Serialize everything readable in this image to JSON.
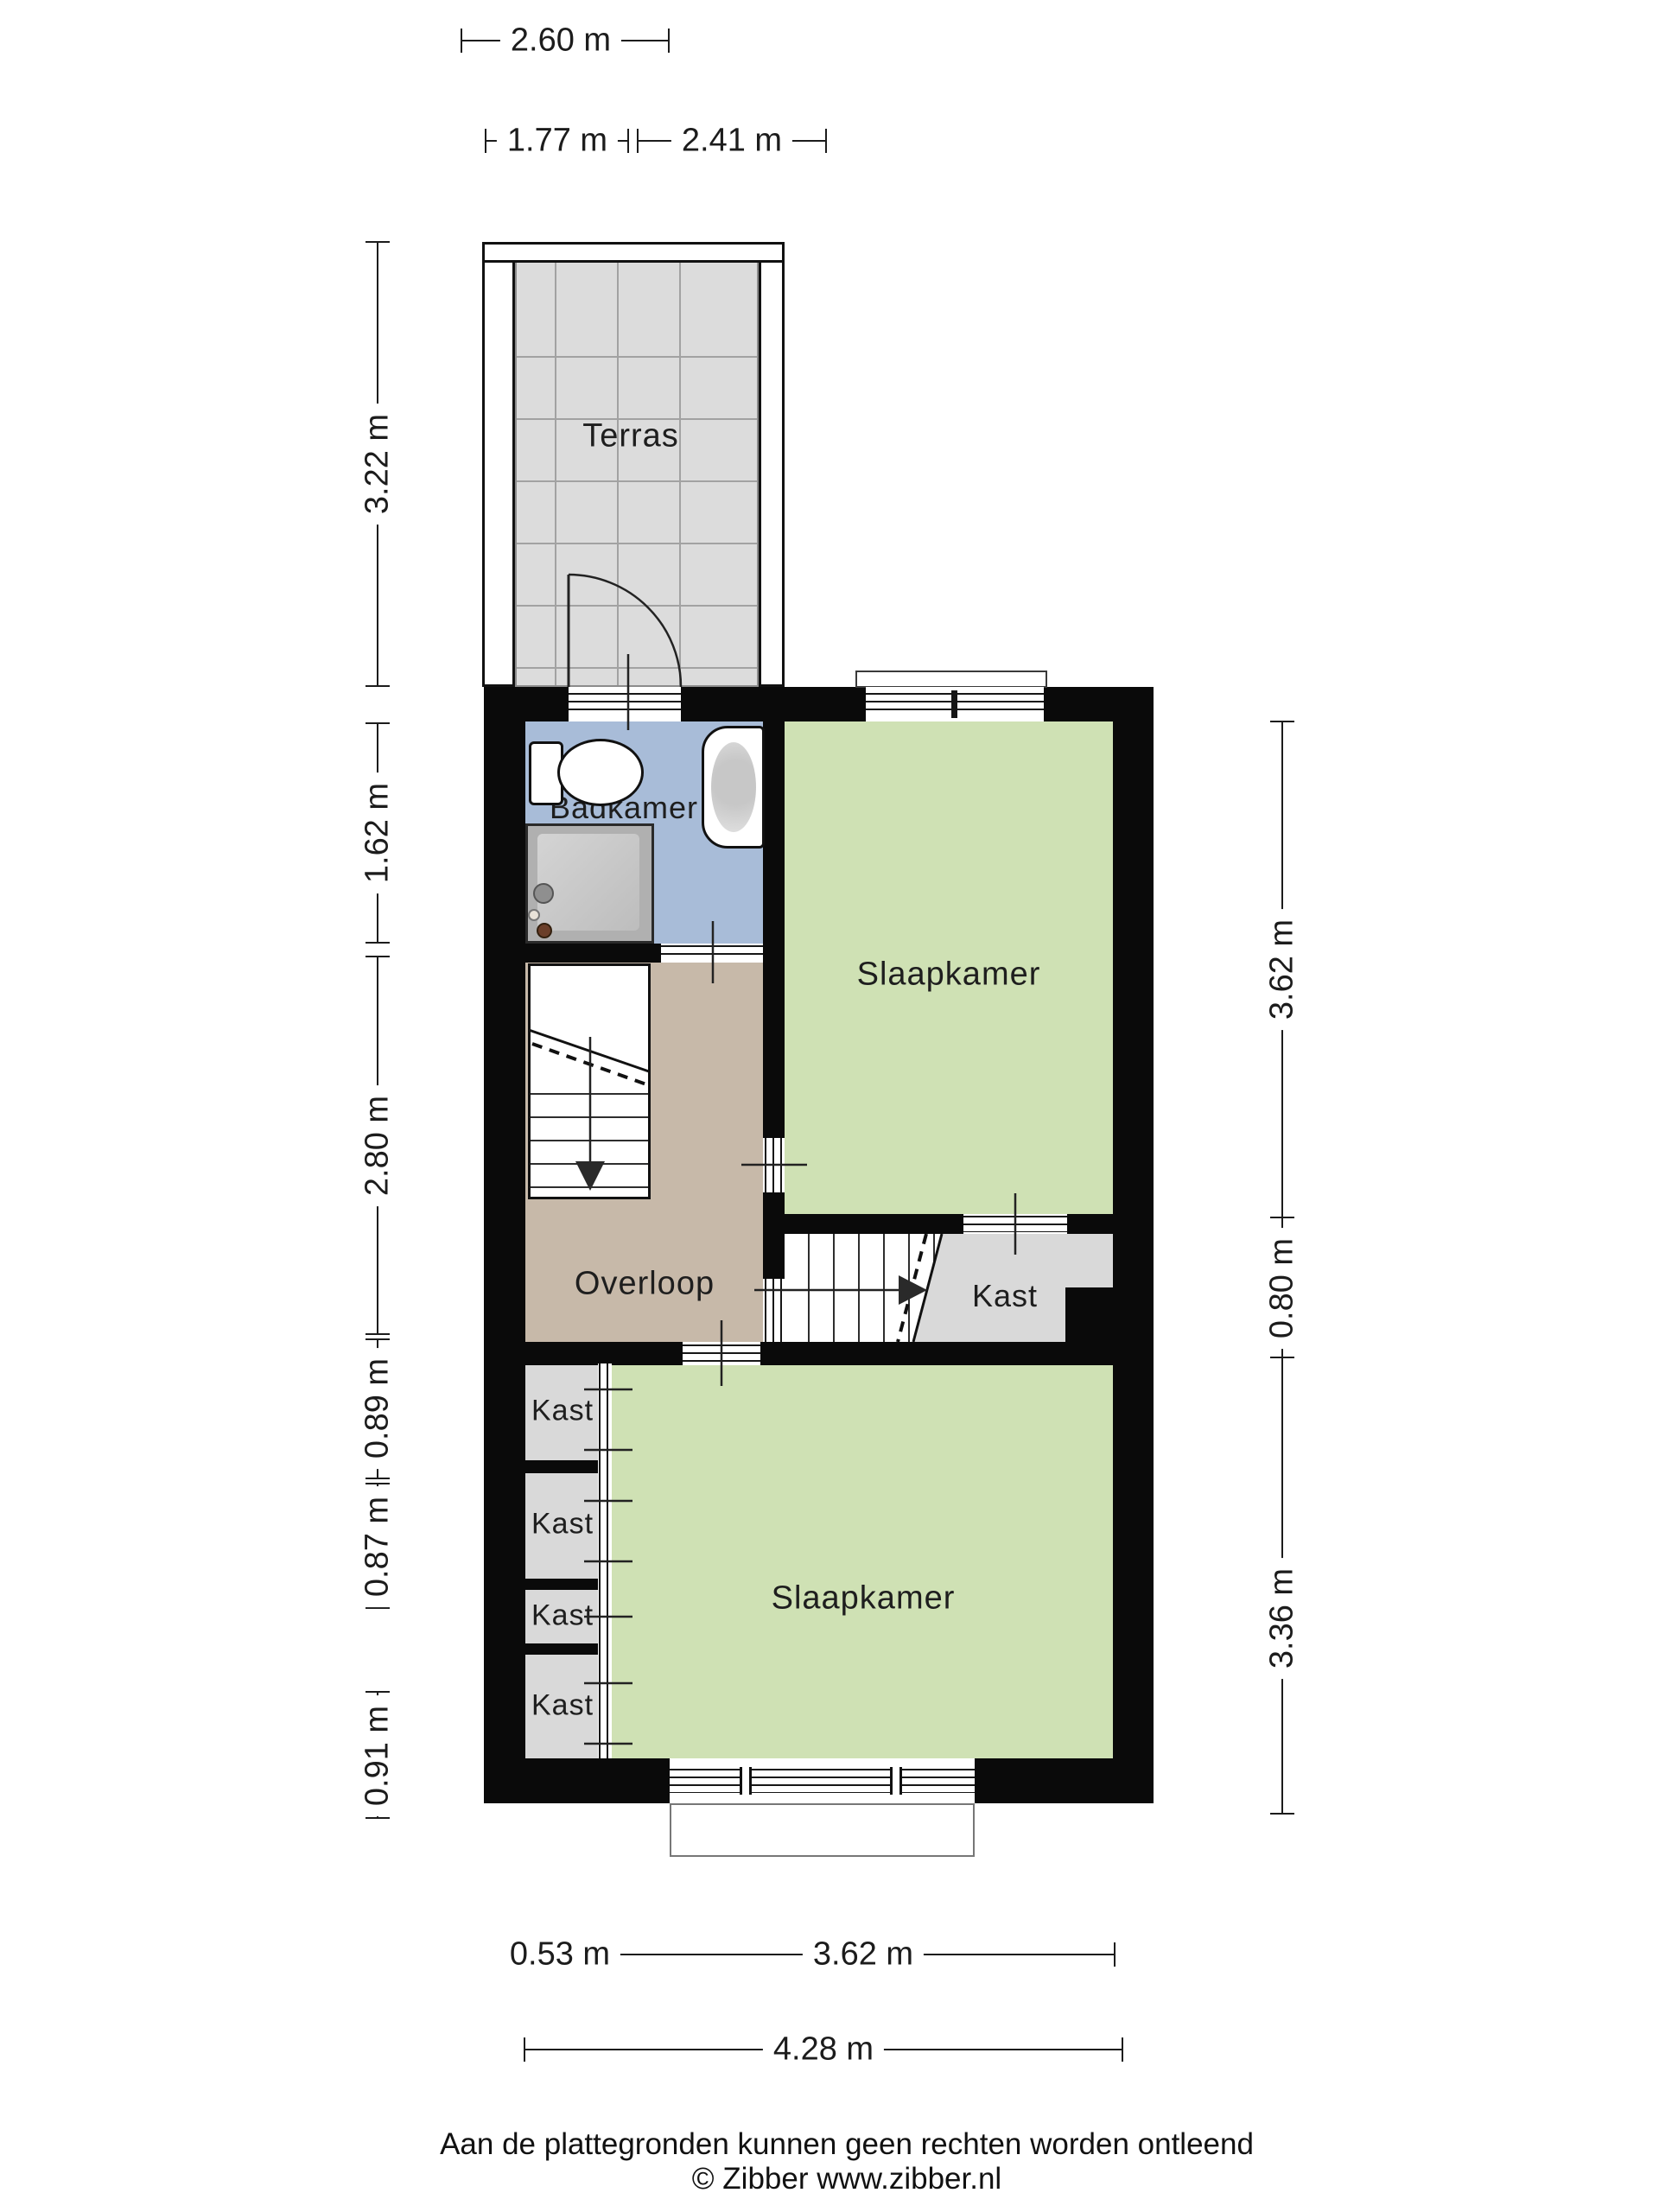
{
  "rooms": {
    "terras": {
      "label": "Terras"
    },
    "badkamer": {
      "label": "Badkamer"
    },
    "slaapkamer_top": {
      "label": "Slaapkamer"
    },
    "overloop": {
      "label": "Overloop"
    },
    "kast_main": {
      "label": "Kast"
    },
    "slaapkamer_bottom": {
      "label": "Slaapkamer"
    },
    "kast_cells": [
      {
        "label": "Kast"
      },
      {
        "label": "Kast"
      },
      {
        "label": "Kast"
      },
      {
        "label": "Kast"
      }
    ]
  },
  "dimensions": {
    "top": [
      {
        "label": "2.60 m"
      },
      {
        "label": "1.77 m"
      },
      {
        "label": "2.41 m"
      }
    ],
    "left": [
      {
        "label": "3.22 m"
      },
      {
        "label": "1.62 m"
      },
      {
        "label": "2.80 m"
      },
      {
        "label": "0.89 m"
      },
      {
        "label": "0.87 m"
      },
      {
        "label": "0.91 m"
      }
    ],
    "right": [
      {
        "label": "3.62 m"
      },
      {
        "label": "0.80 m"
      },
      {
        "label": "3.36 m"
      }
    ],
    "bottom": [
      {
        "label": "0.53 m"
      },
      {
        "label": "3.62 m"
      },
      {
        "label": "4.28 m"
      }
    ]
  },
  "footer": {
    "disclaimer": "Aan de plattegronden kunnen geen rechten worden ontleend",
    "credit": "© Zibber www.zibber.nl"
  },
  "colors": {
    "wall": "#0a0a0a",
    "terrace_tile": "#dcdcdc",
    "bathroom": "#a8bcd8",
    "bedroom": "#cfe1b4",
    "landing": "#c7b9a9",
    "closet": "#d9d9d9"
  }
}
